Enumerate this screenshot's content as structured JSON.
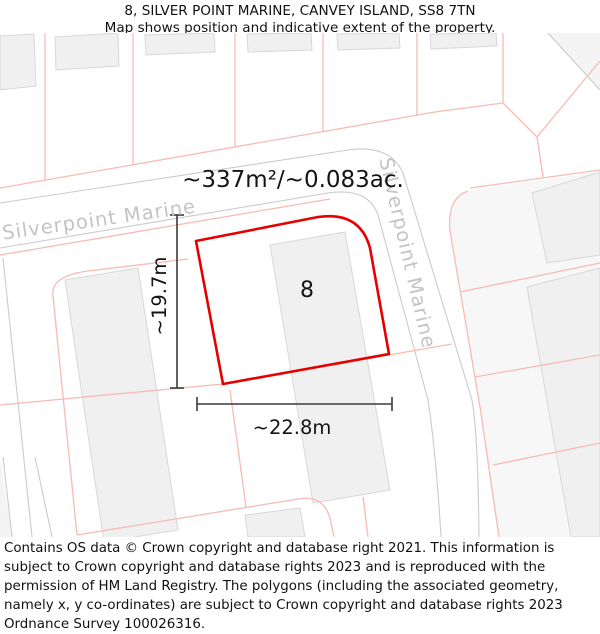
{
  "header": {
    "title": "8, SILVER POINT MARINE, CANVEY ISLAND, SS8 7TN",
    "subtitle": "Map shows position and indicative extent of the property."
  },
  "map": {
    "area_label": "~337m²/~0.083ac.",
    "plot_number": "8",
    "street_label_horizontal": "Silverpoint Marine",
    "street_label_vertical": "Silverpoint Marine",
    "dimensions": {
      "height_label": "~19.7m",
      "width_label": "~22.8m"
    },
    "colors": {
      "property_outline": "#e60000",
      "parcel_line": "#f8bab4",
      "road_line": "#cbcbcb",
      "building_fill": "#f0f0f0",
      "building_stroke": "#d8d8d8",
      "street_label": "#c4c4c4",
      "dimension_line": "#3a3a3a",
      "text": "#111111"
    }
  },
  "footer": {
    "attribution": "Contains OS data © Crown copyright and database right 2021. This information is subject to Crown copyright and database rights 2023 and is reproduced with the permission of HM Land Registry. The polygons (including the associated geometry, namely x, y co-ordinates) are subject to Crown copyright and database rights 2023 Ordnance Survey 100026316."
  }
}
